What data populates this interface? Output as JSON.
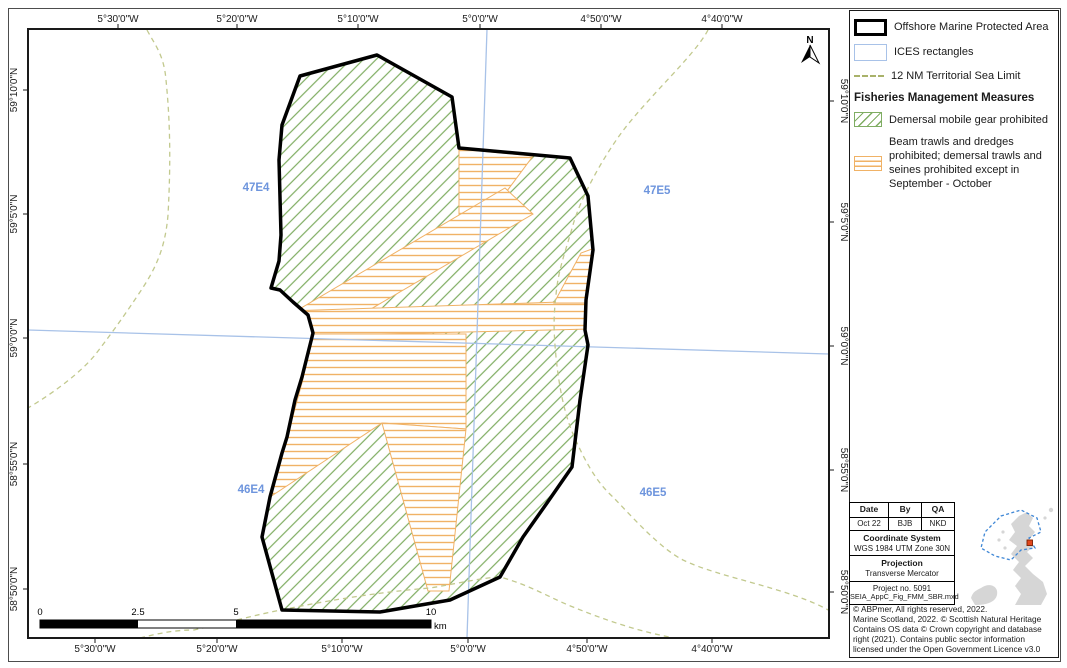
{
  "map": {
    "axis_top": [
      "5°30'0\"W",
      "5°20'0\"W",
      "5°10'0\"W",
      "5°0'0\"W",
      "4°50'0\"W",
      "4°40'0\"W"
    ],
    "axis_bottom": [
      "5°30'0\"W",
      "5°20'0\"W",
      "5°10'0\"W",
      "5°0'0\"W",
      "4°50'0\"W",
      "4°40'0\"W"
    ],
    "axis_left": [
      "59°10'0\"N",
      "59°5'0\"N",
      "59°0'0\"N",
      "58°55'0\"N",
      "58°50'0\"N"
    ],
    "axis_right": [
      "59°10'0\"N",
      "59°5'0\"N",
      "59°0'0\"N",
      "58°55'0\"N",
      "58°50'0\"N"
    ],
    "ices_labels": {
      "nw": "47E4",
      "ne": "47E5",
      "sw": "46E4",
      "se": "46E5"
    },
    "north_label": "N",
    "scalebar": {
      "ticks": [
        "0",
        "2.5",
        "5",
        "10"
      ],
      "unit": "km"
    },
    "colors": {
      "mpa_border": "#000000",
      "green_hatch": "#7fad62",
      "orange_hatch": "#f0b266",
      "ices_line": "#a8c2e8",
      "ices_label": "#6e95dd",
      "territorial_limit": "#c2c98e"
    }
  },
  "legend": {
    "items": [
      {
        "label": "Offshore Marine Protected Area"
      },
      {
        "label": "ICES rectangles"
      },
      {
        "label": "12 NM Territorial Sea Limit"
      }
    ],
    "section_header": "Fisheries Management Measures",
    "measures": [
      {
        "label": "Demersal mobile gear prohibited"
      },
      {
        "label": "Beam trawls and dredges prohibited; demersal trawls and seines prohibited except in September - October"
      }
    ]
  },
  "info_table": {
    "headers": [
      "Date",
      "By",
      "QA"
    ],
    "values": [
      "Oct 22",
      "BJB",
      "NKD"
    ],
    "coordinate_system_label": "Coordinate System",
    "coordinate_system": "WGS 1984 UTM Zone 30N",
    "projection_label": "Projection",
    "projection": "Transverse Mercator",
    "project_no": "Project no. 5091",
    "file_name": "SEIA_AppC_Fig_FMM_SBR.mxd"
  },
  "copyright": {
    "lines": [
      "© ABPmer, All rights reserved, 2022.",
      "Marine Scotland, 2022. © Scottish Natural Heritage",
      "Contains OS data © Crown copyright and database",
      "right (2021). Contains public sector information",
      "licensed under the Open Government Licence v3.0"
    ]
  }
}
